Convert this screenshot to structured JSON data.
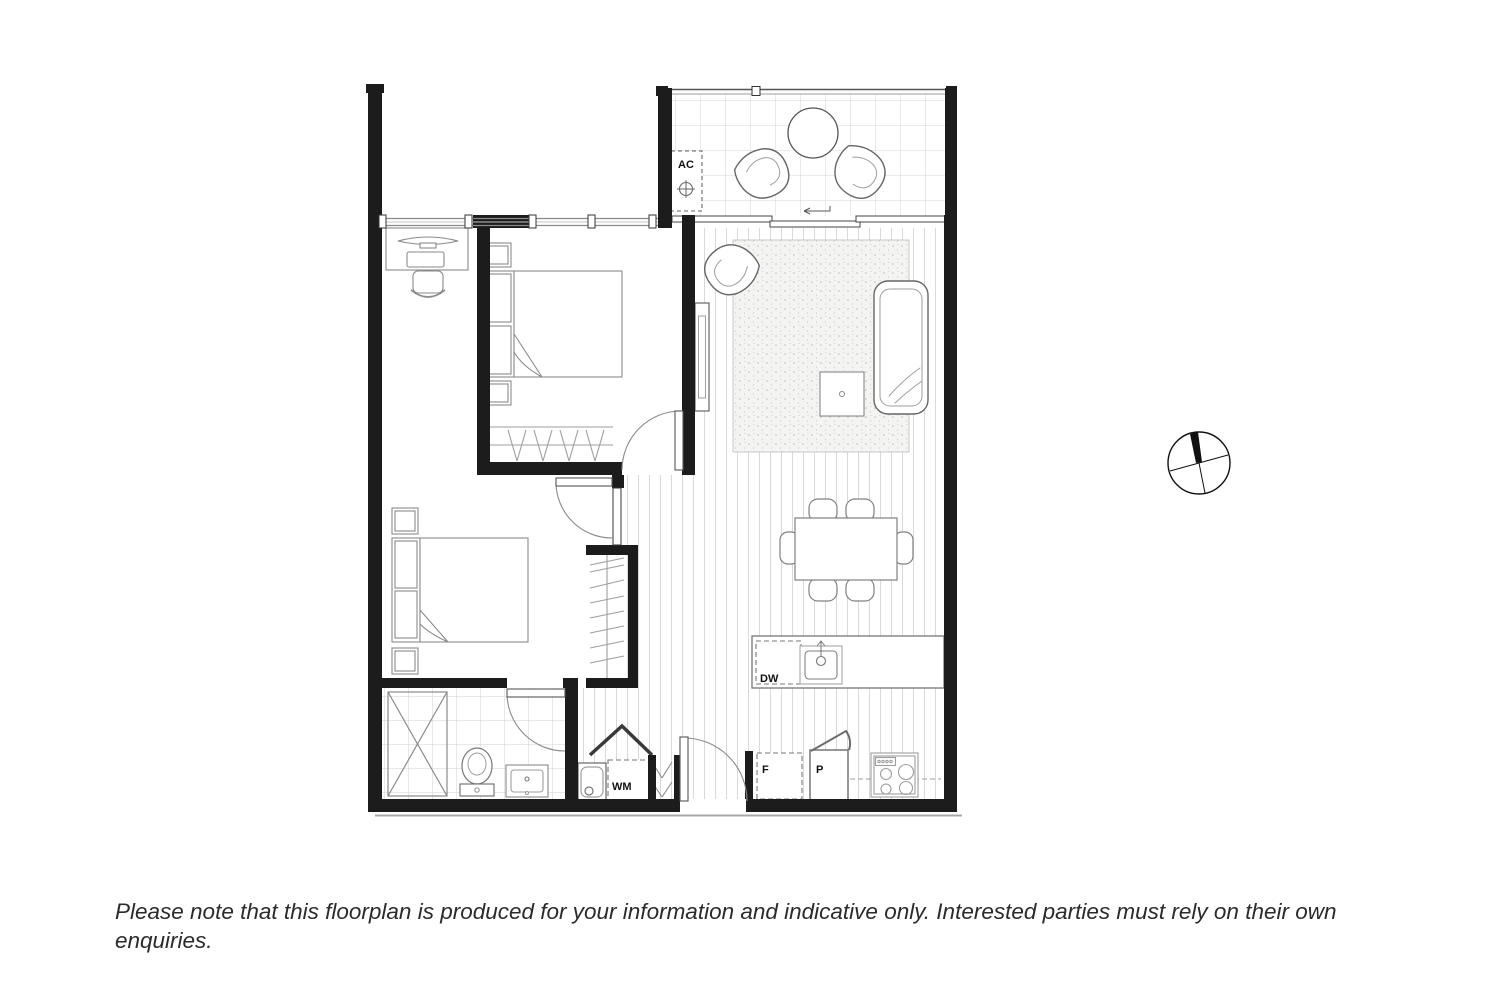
{
  "floorplan": {
    "labels": {
      "air_conditioner": "AC",
      "dishwasher": "DW",
      "fridge": "F",
      "pantry": "P",
      "washing_machine": "WM"
    },
    "colors": {
      "wall": "#1c1c1c",
      "furniture_line": "#777777",
      "light_line": "#9e9e9e",
      "floor_line": "#d9d9d9",
      "background": "#ffffff",
      "label_text": "#111111"
    }
  },
  "disclaimer": {
    "text": "Please note that this floorplan is produced for your information and indicative only. Interested parties must rely on their own enquiries."
  }
}
